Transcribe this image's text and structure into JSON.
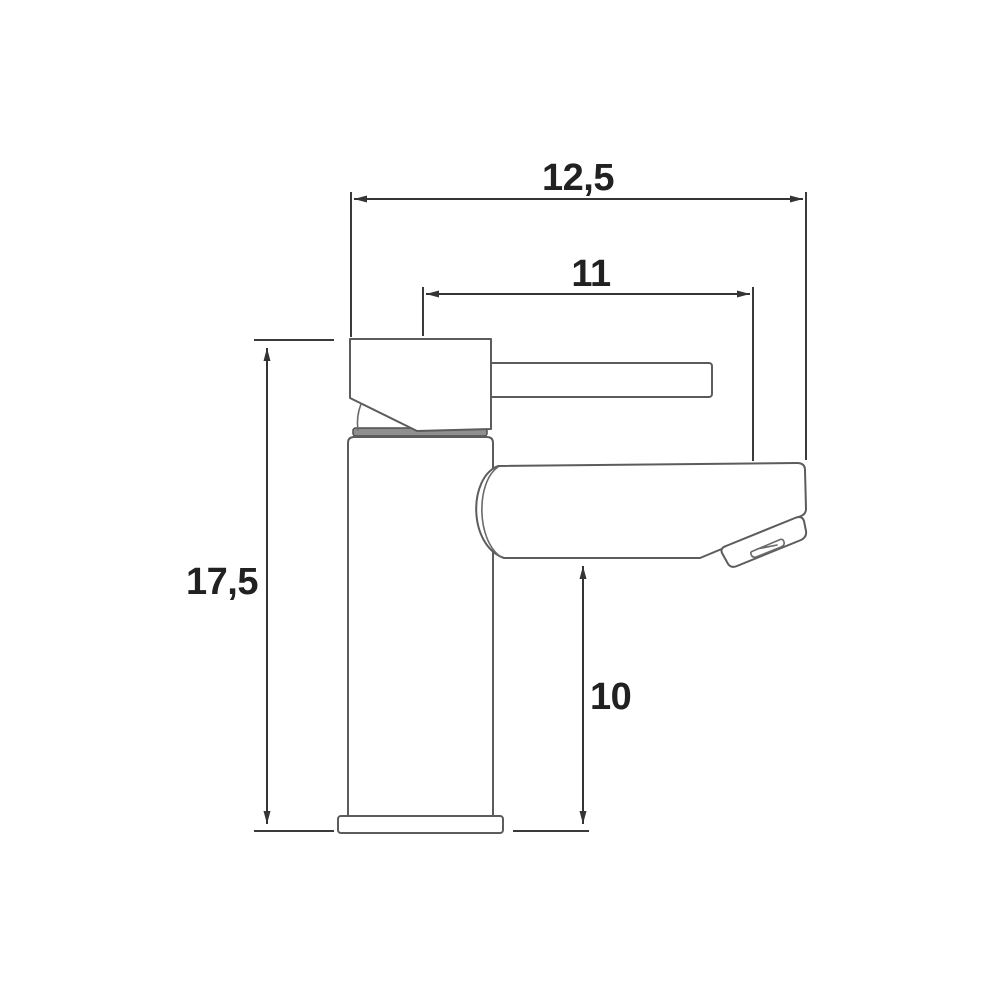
{
  "page": {
    "background": "#ffffff",
    "kind": "technical dimension drawing",
    "subject": "single-lever basin mixer tap, side elevation"
  },
  "colors": {
    "outline": "#5c5c5c",
    "dimension_lines": "#343434",
    "label_text": "#212121",
    "cartridge_seam_fill": "#8f8f8f"
  },
  "dimensions": {
    "overall_width": "12,5",
    "spout_reach": "11",
    "overall_height": "17,5",
    "spout_height": "10"
  }
}
